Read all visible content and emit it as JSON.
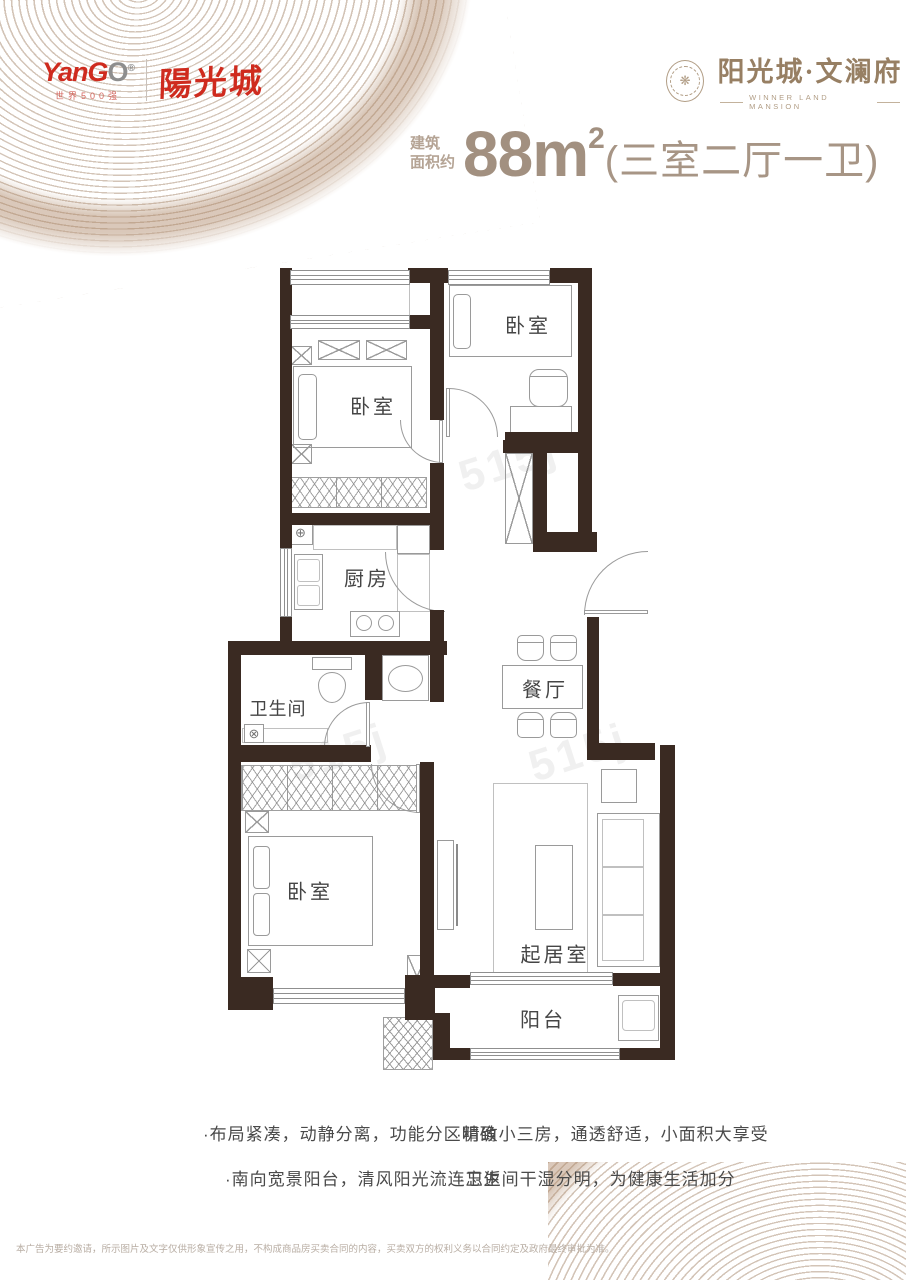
{
  "logo_left": {
    "wordmark_a": "Yan",
    "wordmark_b": "G",
    "wordmark_c": "O",
    "reg": "®",
    "tagline": "世界500强",
    "brand_cn": "陽光城"
  },
  "logo_right": {
    "seal_symbol": "❋",
    "brand": "阳光城·文澜府",
    "subtitle": "WINNER LAND MANSION"
  },
  "title": {
    "prefix_top": "建筑",
    "prefix_bottom": "面积约",
    "area_number": "88",
    "area_unit": "m",
    "area_sup": "2",
    "layout": "(三室二厅一卫)"
  },
  "floorplan": {
    "rooms": [
      {
        "id": "bedroom-top-left",
        "label": "卧室"
      },
      {
        "id": "bedroom-top-right",
        "label": "卧室"
      },
      {
        "id": "kitchen",
        "label": "厨房"
      },
      {
        "id": "bathroom",
        "label": "卫生间"
      },
      {
        "id": "dining",
        "label": "餐厅"
      },
      {
        "id": "bedroom-bottom",
        "label": "卧室"
      },
      {
        "id": "living",
        "label": "起居室"
      },
      {
        "id": "balcony",
        "label": "阳台"
      }
    ],
    "icons": {
      "heater_symbol": "⊕",
      "drain_symbol": "⊗"
    }
  },
  "watermark": "515j",
  "features": {
    "col1": [
      "·布局紧凑，动静分离，功能分区明确",
      "·南向宽景阳台，清风阳光流连忘返"
    ],
    "col2": [
      "·精致小三房，通透舒适，小面积大享受",
      "·卫生间干湿分明，为健康生活加分"
    ]
  },
  "disclaimer": "本广告为要约邀请，所示图片及文字仅供形象宣传之用，不构成商品房买卖合同的内容，买卖双方的权利义务以合同约定及政府最终审批为准。",
  "colors": {
    "brand_red": "#cf2b1e",
    "brand_brown": "#977f63",
    "title_brown": "#a29080",
    "wall": "#3a2a22",
    "ring_beige": "#c3b09d"
  }
}
